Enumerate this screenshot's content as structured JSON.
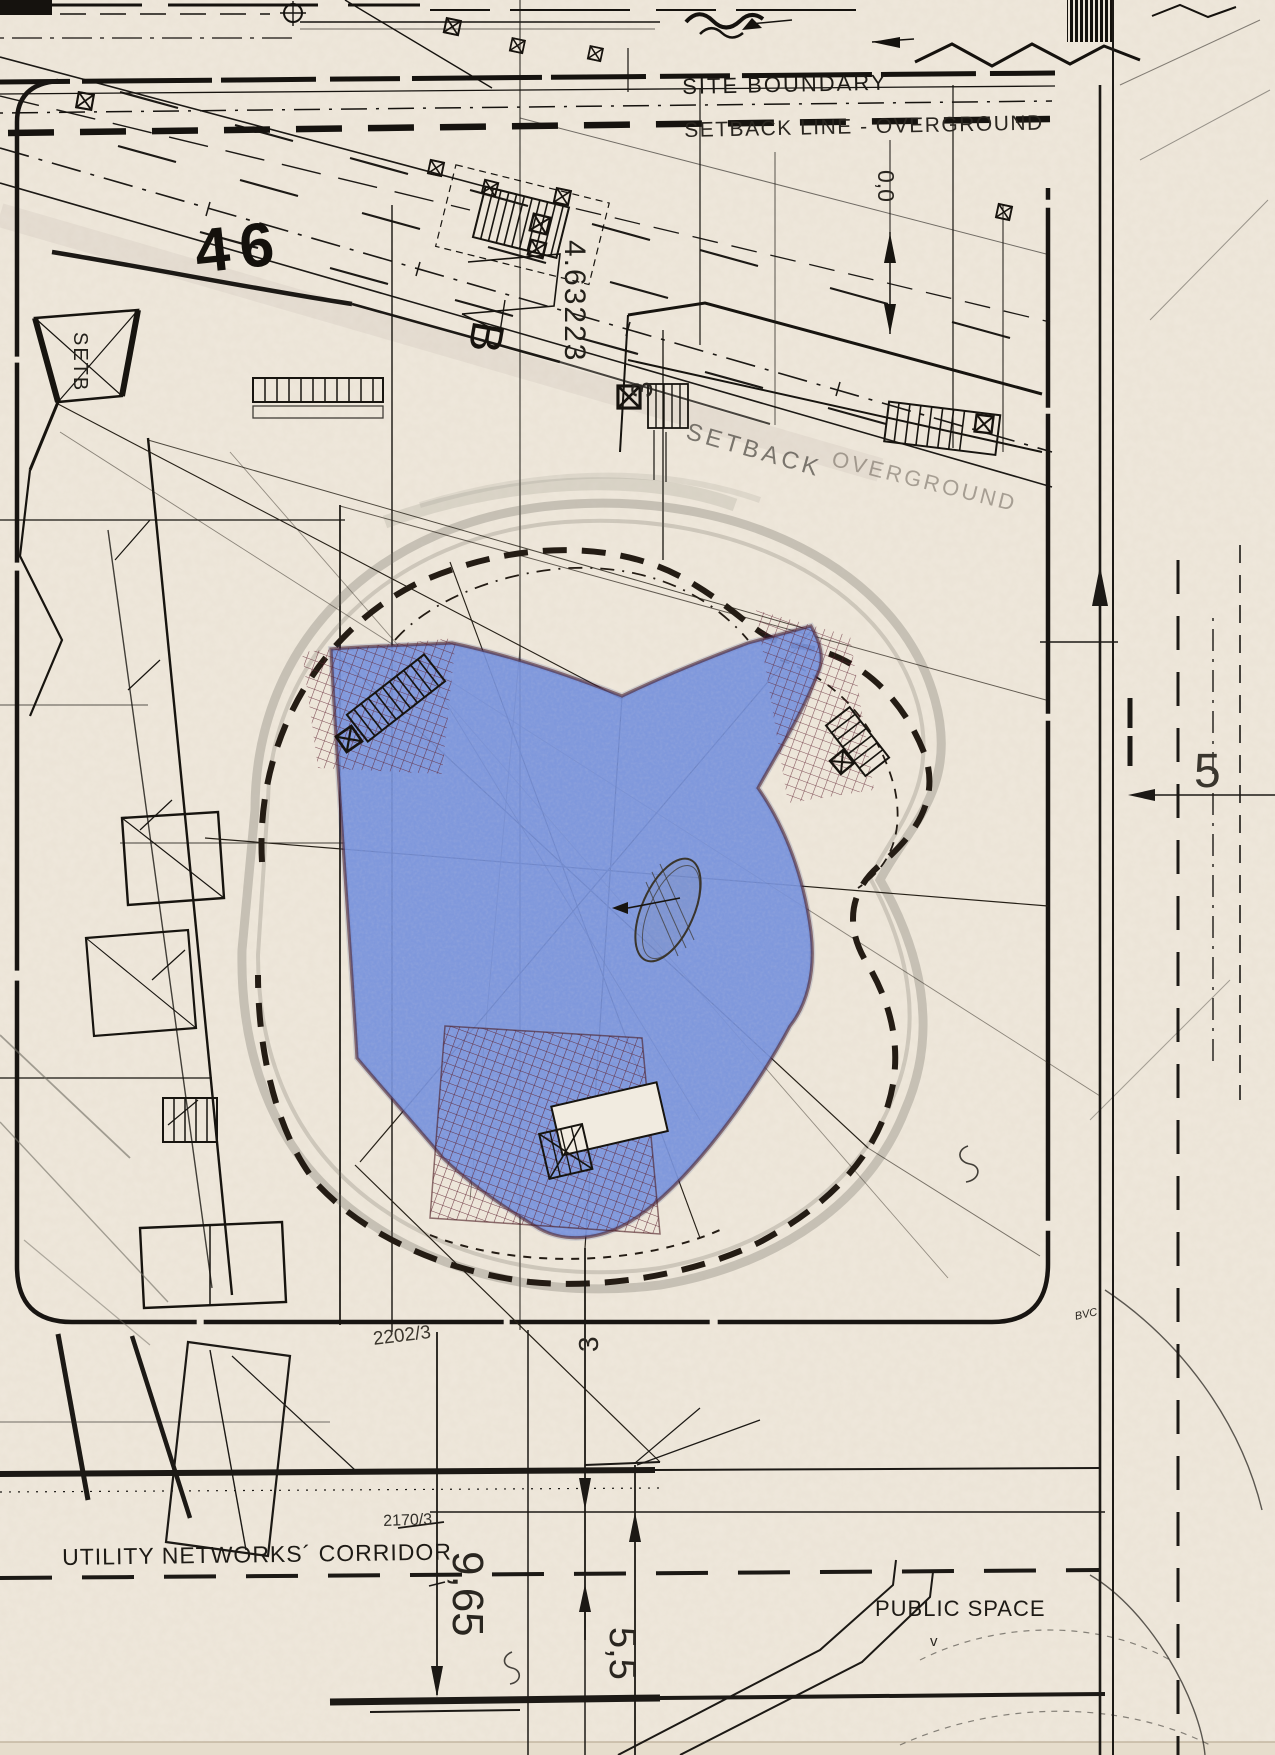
{
  "drawing_title": "hand-drawn architectural site plan sketch",
  "labels": {
    "site_boundary": "SITE BOUNDARY",
    "setback_line_overground": "SETBACK LINE - OVERGROUND",
    "setback_diagonal": "SETBACK",
    "overground_diagonal": "OVERGROUND",
    "utility_corridor": "UTILITY NETWORKS´ CORRIDOR",
    "public_space": "PUBLIC SPACE",
    "public_space_mark": "v",
    "plot_46": "46",
    "plot_2202": "2202/3",
    "plot_2170": "2170/3",
    "dim_4_63223": "4.63223",
    "dim_9_65": "9,65",
    "dim_5_5": "5,5",
    "dim_5": "5",
    "dim_3_upper": "3",
    "dim_3_lower": "3",
    "dim_0_0": "0,0",
    "grid_b": "B",
    "setb_left": "SETB",
    "note_bvc": "BVC"
  },
  "colors": {
    "paper": "#efe8dc",
    "ink": "#1c1915",
    "pencil_gray": "#8a8478",
    "blue_fill": "#5b7bd3",
    "footprint_outline": "#451722",
    "crosshatch": "#5e2130"
  }
}
